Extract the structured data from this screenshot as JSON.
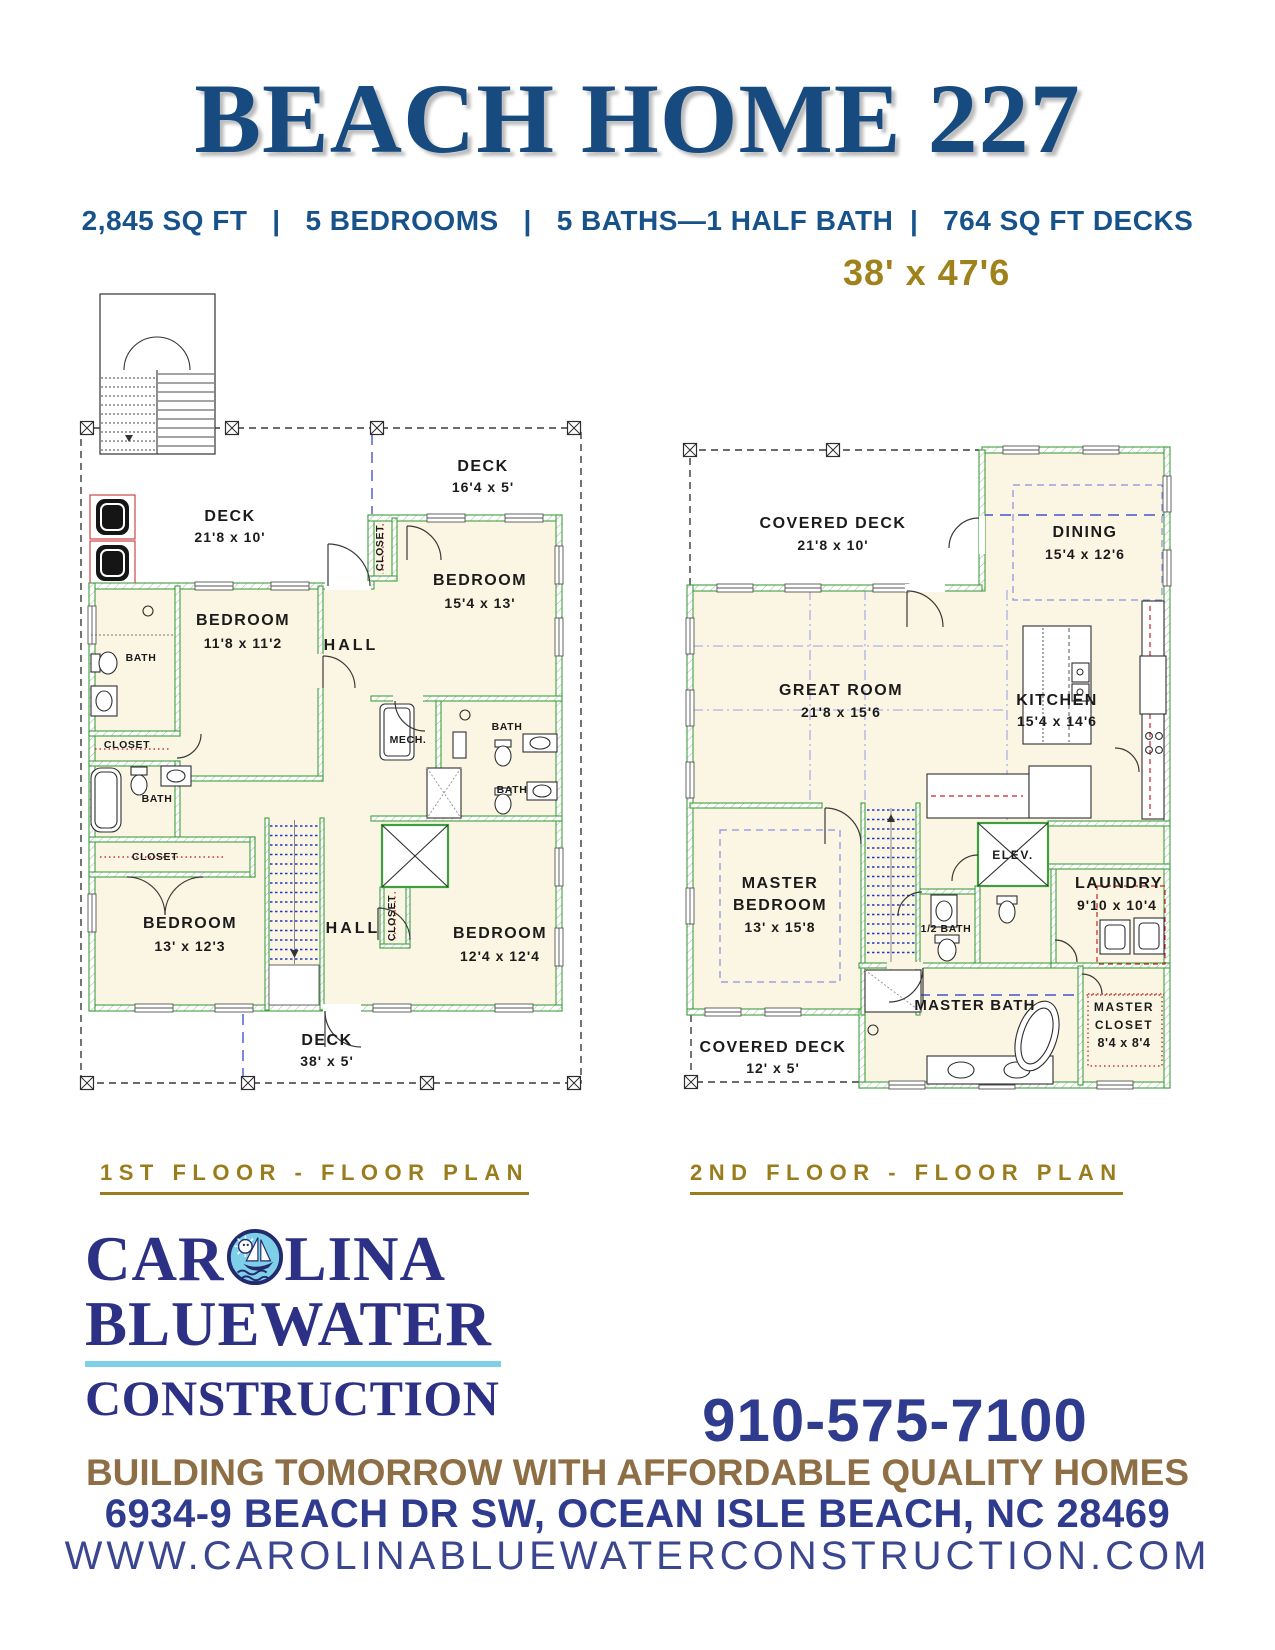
{
  "header": {
    "title": "BEACH HOME 227",
    "specs": "2,845 SQ FT   |   5 BEDROOMS   |   5 BATHS—1 HALF BATH  |   764 SQ FT DECKS",
    "dimensions": "38' x 47'6"
  },
  "floor1": {
    "caption": "1ST FLOOR - FLOOR PLAN",
    "rooms": {
      "deck_main": {
        "name": "DECK",
        "size": "21'8 x 10'"
      },
      "deck_upper": {
        "name": "DECK",
        "size": "16'4 x 5'"
      },
      "closet_upper": "CLOSET",
      "bedroom_upper_right": {
        "name": "BEDROOM",
        "size": "15'4 x 13'"
      },
      "bedroom_left": {
        "name": "BEDROOM",
        "size": "11'8 x 11'2"
      },
      "hall_upper": "HALL",
      "bath_left_upper": "BATH",
      "closet_left_upper": "CLOSET",
      "bath_left_lower": "BATH",
      "closet_left_lower": "CLOSET",
      "bath_right_upper": "BATH",
      "bath_right_lower": "BATH",
      "mech": "MECH.",
      "bedroom_lower_left": {
        "name": "BEDROOM",
        "size": "13' x 12'3"
      },
      "hall_lower": "HALL",
      "closet_elevator": "CLOSET",
      "bedroom_lower_right": {
        "name": "BEDROOM",
        "size": "12'4 x 12'4"
      },
      "deck_lower": {
        "name": "DECK",
        "size": "38' x 5'"
      }
    }
  },
  "floor2": {
    "caption": "2ND FLOOR - FLOOR PLAN",
    "rooms": {
      "covered_deck_upper": {
        "name": "COVERED DECK",
        "size": "21'8 x 10'"
      },
      "dining": {
        "name": "DINING",
        "size": "15'4 x 12'6"
      },
      "great_room": {
        "name": "GREAT ROOM",
        "size": "21'8 x 15'6"
      },
      "kitchen": {
        "name": "KITCHEN",
        "size": "15'4 x 14'6"
      },
      "elevator": "ELEV.",
      "master_bedroom": {
        "line1": "MASTER",
        "line2": "BEDROOM",
        "size": "13' x 15'8"
      },
      "half_bath": "1/2 BATH",
      "laundry": {
        "name": "LAUNDRY",
        "size": "9'10 x 10'4"
      },
      "master_bath": "MASTER BATH",
      "master_closet": {
        "line1": "MASTER",
        "line2": "CLOSET",
        "size": "8'4 x 8'4"
      },
      "covered_deck_lower": {
        "name": "COVERED DECK",
        "size": "12' x 5'"
      }
    }
  },
  "footer": {
    "logo": {
      "part1": "CAR",
      "part2": "LINA",
      "line2": "BLUEWATER",
      "line3": "CONSTRUCTION"
    },
    "phone": "910-575-7100",
    "tagline": "BUILDING TOMORROW WITH AFFORDABLE QUALITY HOMES",
    "address": "6934-9 BEACH DR SW, OCEAN ISLE BEACH, NC 28469",
    "website": "WWW.CAROLINABLUEWATERCONSTRUCTION.COM"
  },
  "colors": {
    "title_navy": "#174a7e",
    "logo_navy": "#2d3185",
    "phone_navy": "#2f3b8e",
    "gold": "#a0821c",
    "caption_gold": "#9b7c1c",
    "tagline_brown": "#8d6e45",
    "wall_green": "#3f9e3f",
    "floor_cream": "#fbf6e3",
    "stair_blue": "#2238c8",
    "cabinet_red": "#cc2222",
    "logo_lightblue": "#7ecfe8"
  }
}
